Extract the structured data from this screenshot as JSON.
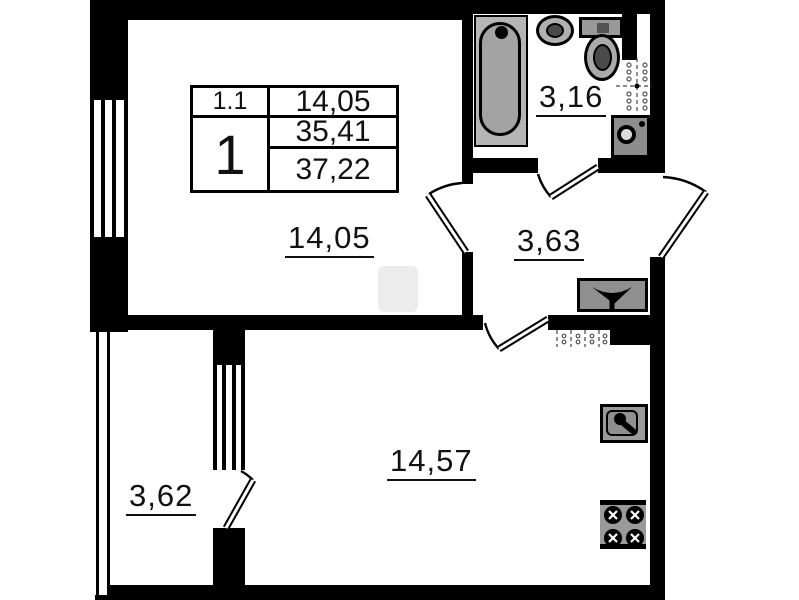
{
  "legend": {
    "room_number": "1.1",
    "room_area": "14,05",
    "apartment_rooms": "1",
    "living_area": "35,41",
    "total_area": "37,22"
  },
  "room_labels": {
    "bedroom": "14,05",
    "bathroom": "3,16",
    "hallway": "3,63",
    "loggia": "3,62",
    "kitchen_living": "14,57"
  },
  "colors": {
    "wall": "#000000",
    "fixture_fill": "#9a9a9a",
    "background": "#ffffff"
  }
}
